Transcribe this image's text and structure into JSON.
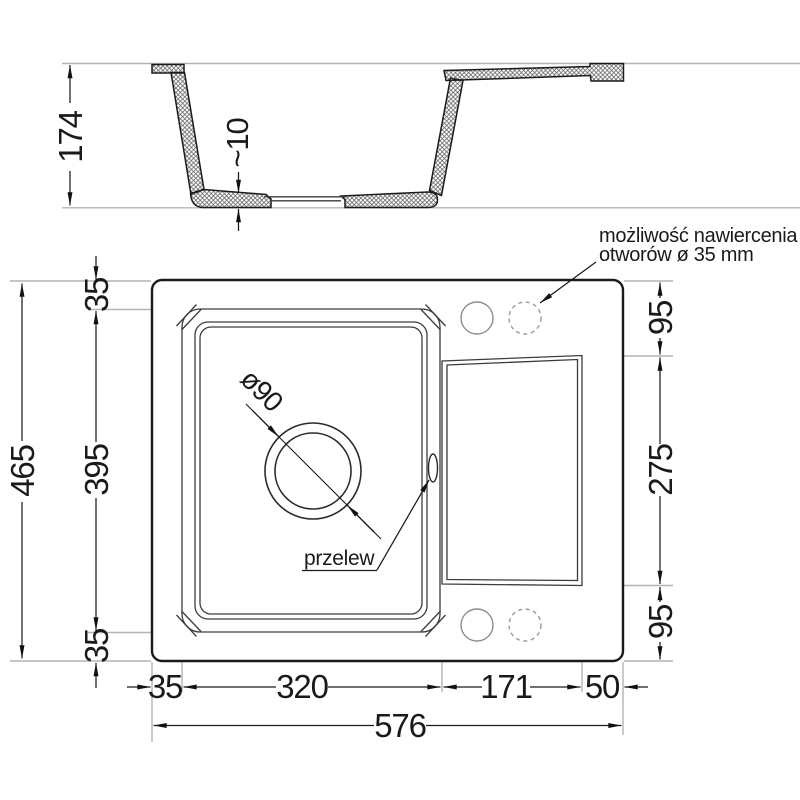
{
  "section_view": {
    "depth_label": "174",
    "bottom_thickness_label": "~10"
  },
  "plan_view": {
    "total_height_label": "465",
    "rim_top_label": "35",
    "bowl_length_label": "395",
    "rim_bottom_label": "35",
    "right_top_label": "95",
    "drainboard_length_label": "275",
    "right_bottom_label": "95",
    "rim_left_label": "35",
    "bowl_width_label": "320",
    "drainboard_width_label": "171",
    "rim_right_label": "50",
    "total_width_label": "576",
    "drain_diameter_label": "ø90",
    "overflow_label": "przelew",
    "drill_note_line1": "możliwość nawiercenia",
    "drill_note_line2": "otworów ø 35 mm"
  },
  "colors": {
    "outline": "#1a1a1a",
    "thin_line": "#3c3c3c",
    "construction_line": "#b4b4b4",
    "hole_outline": "#8c8c8c",
    "background": "#ffffff"
  }
}
